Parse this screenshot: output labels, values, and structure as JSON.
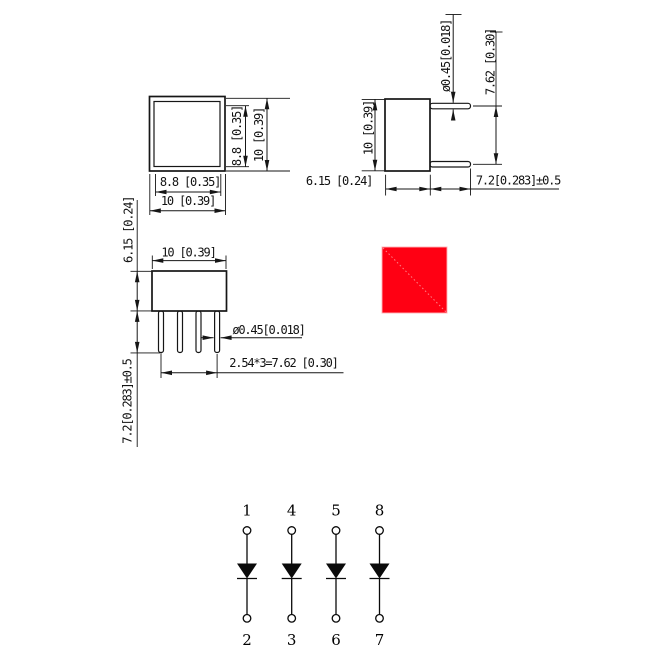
{
  "views": {
    "front": {
      "width_inner": "8.8 [0.35]",
      "width_outer": "10 [0.39]",
      "height_inner": "8.8 [0.35]",
      "height_outer": "10 [0.39]"
    },
    "side": {
      "lead_dia": "ø0.45[0.018]",
      "lead_span": "7.62 [0.30]",
      "height": "10 [0.39]",
      "depth": "6.15 [0.24]",
      "lead_len": "7.2[0.283]±0.5"
    },
    "top": {
      "width": "10 [0.39]",
      "lead_dia": "ø0.45[0.018]",
      "lead_pitch": "2.54*3=7.62 [0.30]",
      "depth": "6.15 [0.24]",
      "lead_len": "7.2[0.283]±0.5"
    }
  },
  "led": {
    "color": "#ff0013",
    "edge_color": "#ffb0b6"
  },
  "schematic": {
    "top_pins": [
      "1",
      "4",
      "5",
      "8"
    ],
    "bottom_pins": [
      "2",
      "3",
      "6",
      "7"
    ]
  }
}
